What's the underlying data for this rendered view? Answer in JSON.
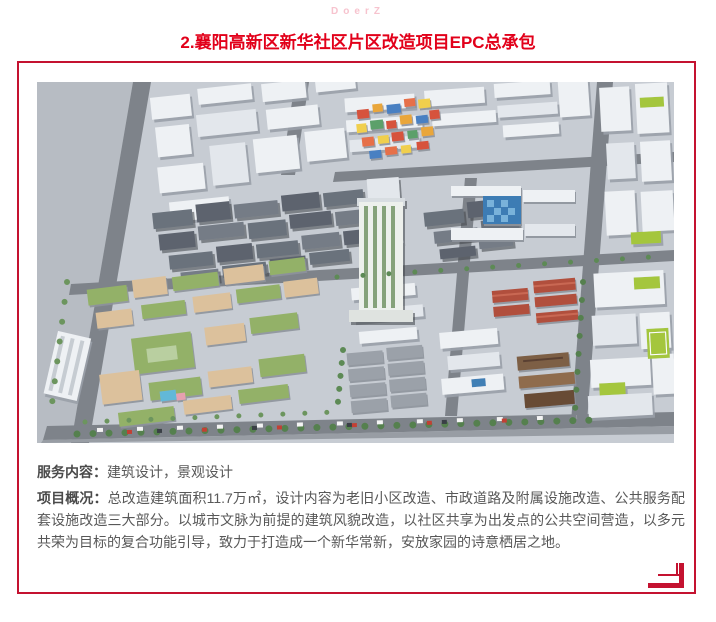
{
  "header": {
    "brand": "DoerZ",
    "title": "2.襄阳高新区新华社区片区改造项目EPC总承包"
  },
  "details": {
    "service_label": "服务内容：",
    "service_value": "建筑设计，景观设计",
    "overview_label": "项目概况：",
    "overview_text": "总改造建筑面积11.7万㎡，设计内容为老旧小区改造、市政道路及附属设施改造、公共服务配套设施改造三大部分。以城市文脉为前提的建筑风貌改造，以社区共享为出发点的公共空间营造，以多元共荣为目标的复合功能引导，致力于打造成一个新华常新，安放家园的诗意栖居之地。"
  },
  "colors": {
    "title_red": "#e2001a",
    "frame_red": "#c41230",
    "brand_pink": "#f7c3ce",
    "body_text": "#585858"
  }
}
